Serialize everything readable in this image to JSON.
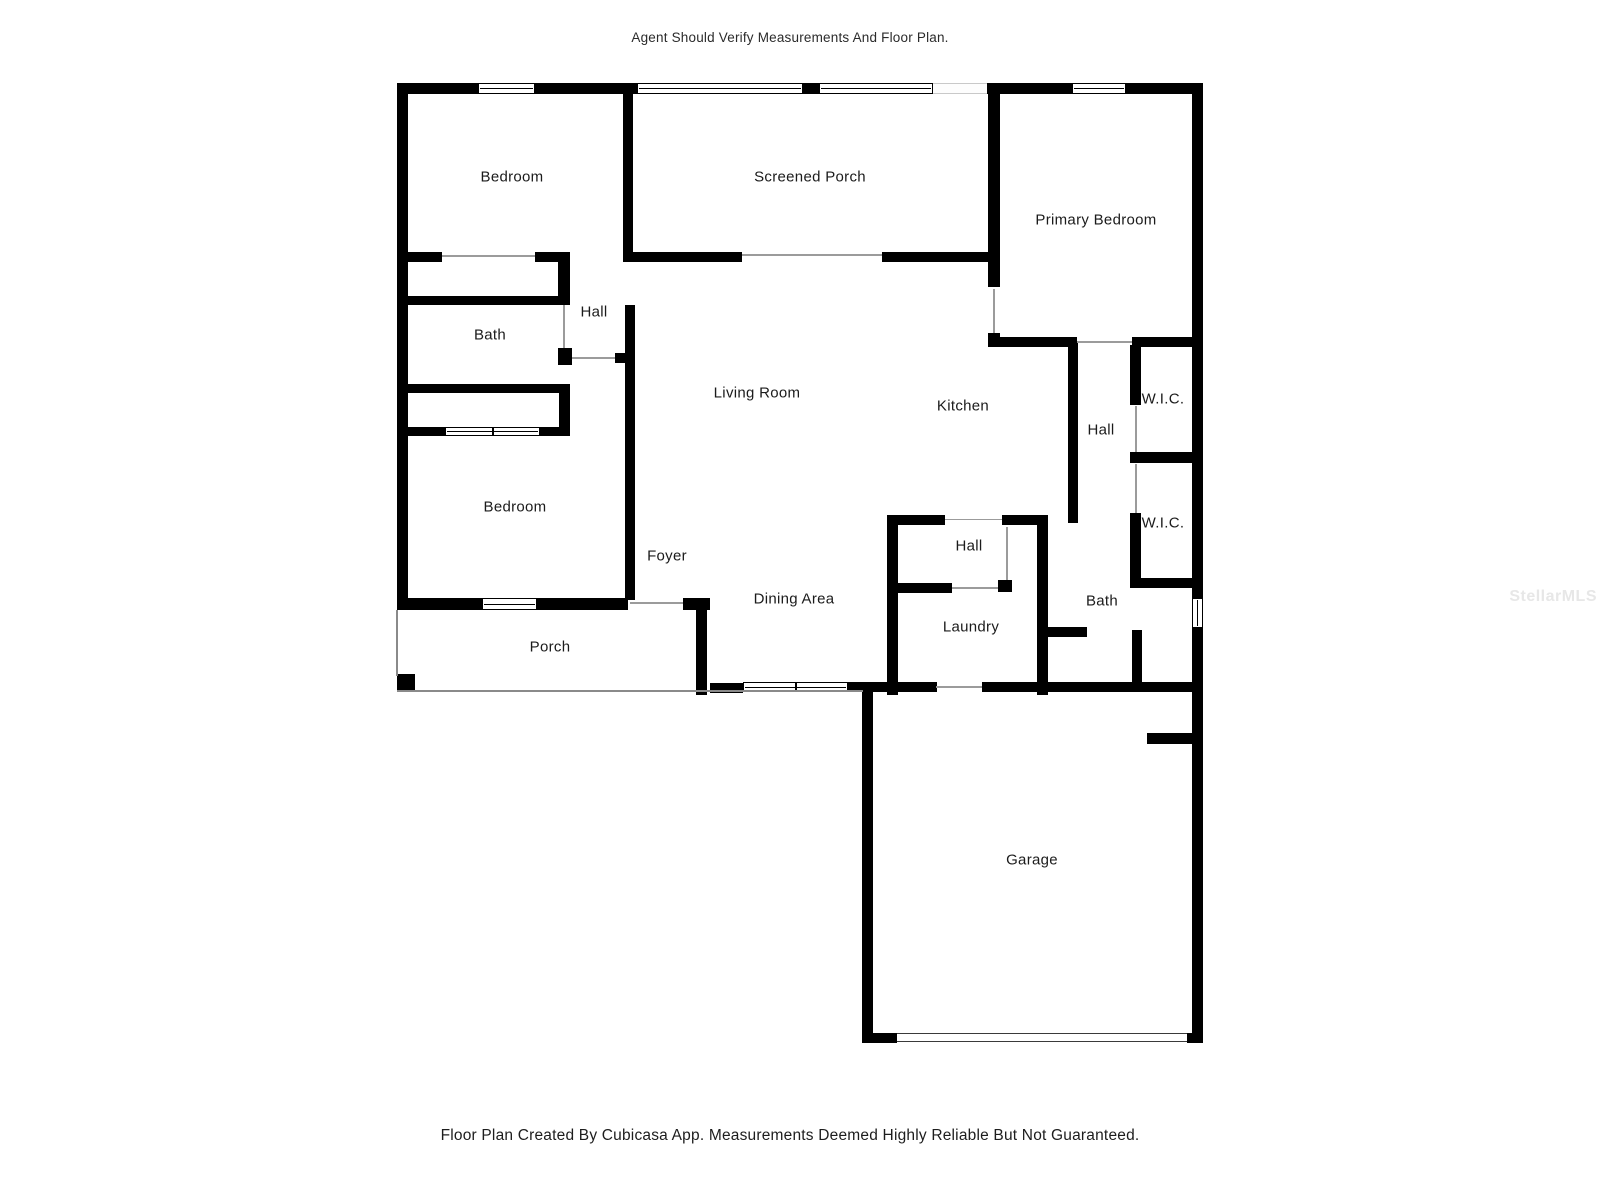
{
  "header": {
    "disclaimer": "Agent Should Verify Measurements And Floor Plan."
  },
  "footer": {
    "disclaimer": "Floor Plan Created By Cubicasa App. Measurements Deemed Highly Reliable But Not Guaranteed."
  },
  "watermark": {
    "text": "StellarMLS",
    "color": "#e7e7e7"
  },
  "colors": {
    "wall": "#000000",
    "label": "#1b1b1b",
    "thin_line": "#9b9b9b"
  },
  "floor_plan": {
    "rooms": [
      {
        "name": "bedroom-1",
        "label": "Bedroom",
        "x": 512,
        "y": 177
      },
      {
        "name": "screened-porch",
        "label": "Screened Porch",
        "x": 810,
        "y": 177
      },
      {
        "name": "primary-bedroom",
        "label": "Primary Bedroom",
        "x": 1096,
        "y": 220
      },
      {
        "name": "bath-1",
        "label": "Bath",
        "x": 490,
        "y": 335
      },
      {
        "name": "hall-1",
        "label": "Hall",
        "x": 594,
        "y": 312
      },
      {
        "name": "living-room",
        "label": "Living Room",
        "x": 757,
        "y": 393
      },
      {
        "name": "kitchen",
        "label": "Kitchen",
        "x": 963,
        "y": 406
      },
      {
        "name": "hall-2",
        "label": "Hall",
        "x": 1101,
        "y": 430
      },
      {
        "name": "wic-1",
        "label": "W.I.C.",
        "x": 1163,
        "y": 399
      },
      {
        "name": "wic-2",
        "label": "W.I.C.",
        "x": 1163,
        "y": 523
      },
      {
        "name": "bedroom-2",
        "label": "Bedroom",
        "x": 515,
        "y": 507
      },
      {
        "name": "foyer",
        "label": "Foyer",
        "x": 667,
        "y": 556
      },
      {
        "name": "hall-3",
        "label": "Hall",
        "x": 969,
        "y": 546
      },
      {
        "name": "dining-area",
        "label": "Dining Area",
        "x": 794,
        "y": 599
      },
      {
        "name": "laundry",
        "label": "Laundry",
        "x": 971,
        "y": 627
      },
      {
        "name": "bath-2",
        "label": "Bath",
        "x": 1102,
        "y": 601
      },
      {
        "name": "porch",
        "label": "Porch",
        "x": 550,
        "y": 647
      },
      {
        "name": "garage",
        "label": "Garage",
        "x": 1032,
        "y": 860
      }
    ],
    "walls": [
      [
        397,
        83,
        81,
        11
      ],
      [
        535,
        83,
        102,
        11
      ],
      [
        803,
        83,
        16,
        11
      ],
      [
        987,
        83,
        85,
        11
      ],
      [
        1126,
        83,
        77,
        11
      ],
      [
        397,
        83,
        11,
        527
      ],
      [
        1192,
        83,
        11,
        515
      ],
      [
        1192,
        628,
        11,
        415
      ],
      [
        623,
        94,
        10,
        168
      ],
      [
        397,
        252,
        45,
        10
      ],
      [
        535,
        252,
        35,
        10
      ],
      [
        397,
        296,
        173,
        9
      ],
      [
        558,
        262,
        12,
        43
      ],
      [
        558,
        348,
        14,
        17
      ],
      [
        397,
        384,
        173,
        9
      ],
      [
        559,
        384,
        11,
        52
      ],
      [
        397,
        427,
        48,
        9
      ],
      [
        540,
        427,
        30,
        9
      ],
      [
        625,
        305,
        10,
        295
      ],
      [
        615,
        353,
        10,
        10
      ],
      [
        397,
        598,
        85,
        12
      ],
      [
        537,
        598,
        91,
        12
      ],
      [
        683,
        598,
        27,
        12
      ],
      [
        696,
        605,
        11,
        90
      ],
      [
        630,
        252,
        112,
        10
      ],
      [
        882,
        252,
        118,
        10
      ],
      [
        988,
        94,
        12,
        193
      ],
      [
        988,
        333,
        12,
        14
      ],
      [
        993,
        337,
        84,
        10
      ],
      [
        1132,
        337,
        71,
        10
      ],
      [
        1068,
        342,
        10,
        181
      ],
      [
        1130,
        345,
        11,
        60
      ],
      [
        1130,
        452,
        73,
        11
      ],
      [
        1130,
        513,
        11,
        75
      ],
      [
        1130,
        578,
        73,
        10
      ],
      [
        887,
        515,
        11,
        180
      ],
      [
        887,
        515,
        58,
        10
      ],
      [
        1002,
        515,
        46,
        10
      ],
      [
        998,
        580,
        14,
        12
      ],
      [
        887,
        583,
        65,
        10
      ],
      [
        1037,
        515,
        11,
        180
      ],
      [
        1043,
        627,
        44,
        10
      ],
      [
        1132,
        630,
        10,
        55
      ],
      [
        710,
        683,
        33,
        10
      ],
      [
        847,
        682,
        90,
        10
      ],
      [
        982,
        682,
        221,
        10
      ],
      [
        862,
        692,
        11,
        351
      ],
      [
        862,
        1033,
        35,
        10
      ],
      [
        1187,
        1033,
        16,
        10
      ],
      [
        1147,
        733,
        56,
        11
      ],
      [
        397,
        674,
        18,
        16
      ]
    ],
    "windows": [
      {
        "x": 478,
        "y": 83,
        "w": 57,
        "h": 11,
        "v": false,
        "tick": false
      },
      {
        "x": 637,
        "y": 83,
        "w": 166,
        "h": 11,
        "v": false,
        "tick": false
      },
      {
        "x": 819,
        "y": 83,
        "w": 114,
        "h": 11,
        "v": false,
        "tick": false
      },
      {
        "x": 1072,
        "y": 83,
        "w": 54,
        "h": 11,
        "v": false,
        "tick": false
      },
      {
        "x": 482,
        "y": 598,
        "w": 55,
        "h": 12,
        "v": false,
        "tick": false
      },
      {
        "x": 1192,
        "y": 598,
        "w": 11,
        "h": 30,
        "v": true,
        "tick": false
      },
      {
        "x": 445,
        "y": 427,
        "w": 95,
        "h": 9,
        "v": false,
        "tick": true
      },
      {
        "x": 743,
        "y": 682,
        "w": 105,
        "h": 10,
        "v": false,
        "tick": true
      }
    ],
    "screens": [
      {
        "x": 933,
        "y": 83,
        "w": 54,
        "h": 11
      }
    ],
    "door_lines": [
      [
        442,
        255,
        93,
        2
      ],
      [
        563,
        305,
        2,
        43
      ],
      [
        630,
        602,
        53,
        2
      ],
      [
        742,
        254,
        140,
        2
      ],
      [
        993,
        289,
        2,
        44
      ],
      [
        1077,
        341,
        55,
        2
      ],
      [
        1135,
        406,
        2,
        46
      ],
      [
        1135,
        464,
        2,
        49
      ],
      [
        952,
        587,
        46,
        2
      ],
      [
        1006,
        527,
        2,
        53
      ],
      [
        936,
        686,
        46,
        2
      ],
      [
        945,
        519,
        57,
        1
      ],
      [
        572,
        357,
        43,
        2
      ]
    ],
    "porch_lines": [
      [
        396,
        610,
        2,
        66
      ],
      [
        397,
        690,
        466,
        2
      ]
    ],
    "garage_door": {
      "x": 897,
      "y": 1033,
      "w": 290,
      "h": 9
    }
  }
}
